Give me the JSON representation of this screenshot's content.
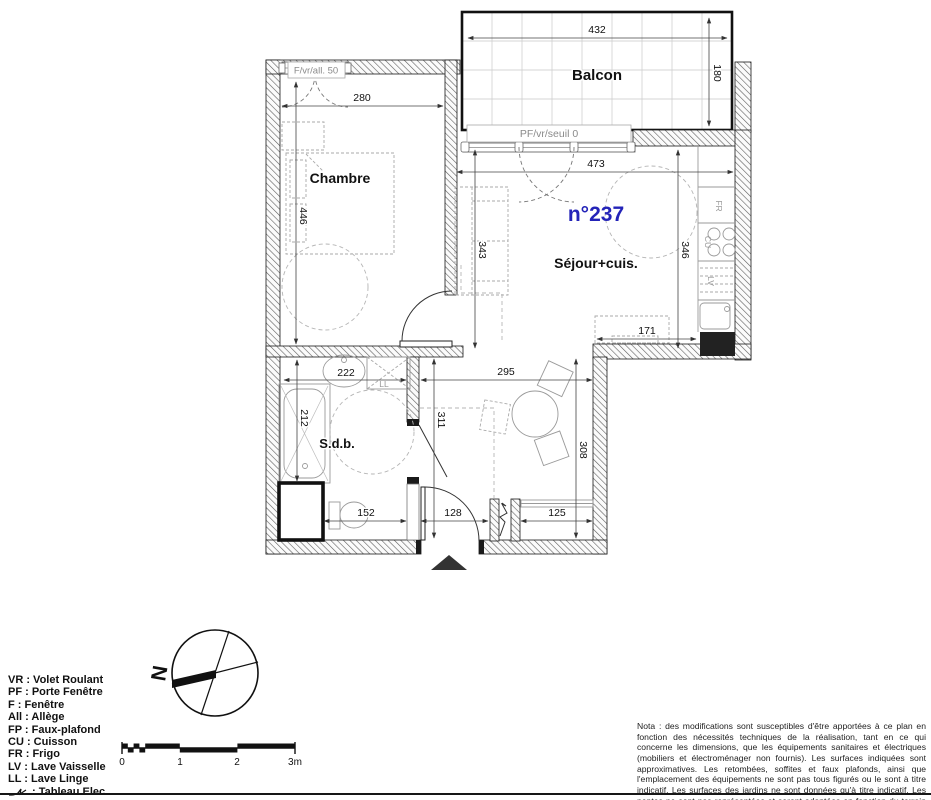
{
  "plan": {
    "unit_number": "n°237",
    "accent_color": "#2323b8",
    "rooms": {
      "balcon": "Balcon",
      "chambre": "Chambre",
      "sejour": "Séjour+cuis.",
      "sdb": "S.d.b."
    },
    "openings": {
      "chambre_window": "F/vr/all. 50",
      "sejour_window": "PF/vr/seuil 0"
    },
    "appliances": {
      "fr": "FR",
      "cu": "CU",
      "lv": "LV",
      "ll": "LL"
    },
    "dims": {
      "balcon_w": "432",
      "balcon_d": "180",
      "chambre_w": "280",
      "chambre_d": "446",
      "sejour_w": "473",
      "sejour_left": "343",
      "sejour_right": "346",
      "desk_w": "171",
      "hall_w": "295",
      "hall_h": "311",
      "dining_h": "308",
      "sdb_w": "222",
      "bath_l": "212",
      "sdb_low_w": "152",
      "entry_w": "128",
      "closet_w": "125"
    }
  },
  "legend": {
    "items": [
      "VR : Volet Roulant",
      "PF : Porte Fenêtre",
      "F : Fenêtre",
      "All : Allège",
      "FP : Faux-plafond",
      "CU : Cuisson",
      "FR : Frigo",
      "LV : Lave Vaisselle",
      "LL : Lave Linge"
    ],
    "elec_label": ": Tableau Elec."
  },
  "compass": {
    "north_label": "N"
  },
  "scale_bar": {
    "labels": [
      "0",
      "1",
      "2",
      "3m"
    ]
  },
  "note": {
    "text": "Nota : des modifications sont susceptibles d'être apportées à ce plan en fonction des nécessités techniques de la réalisation, tant en ce qui concerne les dimensions, que les équipements sanitaires et électriques (mobiliers et électroménager non fournis). Les surfaces indiquées sont approximatives. Les retombées, soffites et faux plafonds, ainsi que l'emplacement des équipements ne sont pas tous figurés ou le sont à titre indicatif. Les surfaces des jardins ne sont données qu'à titre indicatif. Les pentes ne sont pas représentées et seront adaptées en fonction du terrain naturel."
  }
}
